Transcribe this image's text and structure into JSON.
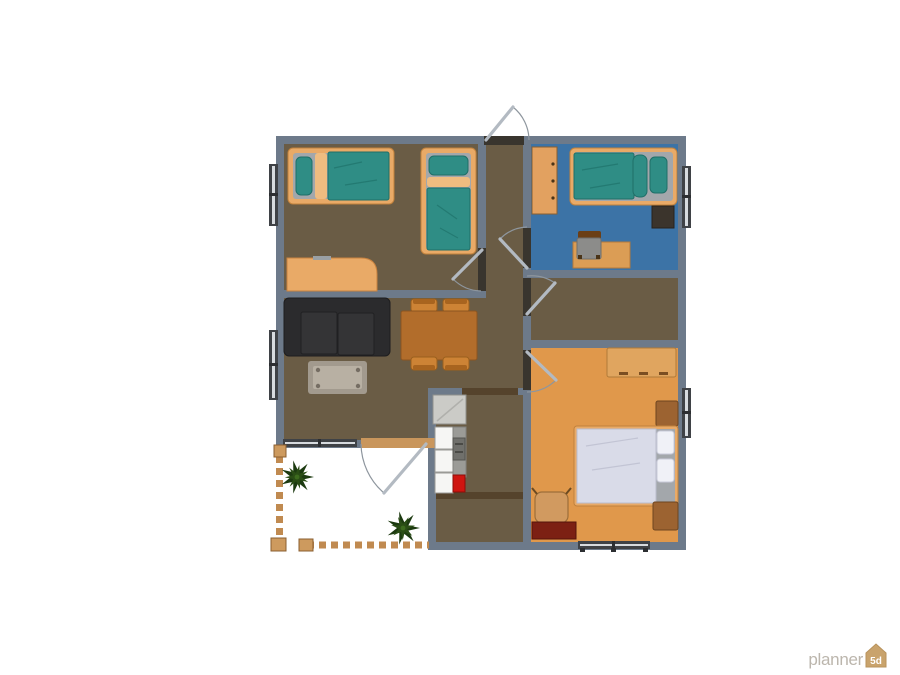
{
  "watermark": {
    "brand": "planner",
    "badge": "5d"
  },
  "palette": {
    "wall": "#6d7a8a",
    "floor_wood_brown": "#6a5c45",
    "floor_blue": "#3c73a6",
    "floor_orange": "#e0984b",
    "patio_floor": "#ffffff",
    "furniture_tan": "#e9aa67",
    "mattress_teal": "#2f8d85",
    "sofa_black": "#2b2b2d",
    "dining_table_wood": "#b26d2b",
    "duvet_white": "#d9dbe8",
    "kitchen_red_appliance": "#cf1510",
    "vanity_maroon": "#7c2013",
    "plant_green": "#1c3a10",
    "fence_tan": "#c08a50",
    "door_frame_dark": "#39352e",
    "logo_gray": "#bcb6ad",
    "logo_badge_tan": "#c9a36c"
  },
  "floor_plan": {
    "rooms": [
      {
        "name": "bedroom-top-left",
        "floor": "wood-brown",
        "furniture": [
          "single-bed-horizontal",
          "single-bed-vertical",
          "desk"
        ]
      },
      {
        "name": "bedroom-top-right",
        "floor": "blue",
        "furniture": [
          "wardrobe",
          "single-bed",
          "tv-stand",
          "desk",
          "desk-chair"
        ]
      },
      {
        "name": "corridor",
        "floor": "wood-brown",
        "furniture": []
      },
      {
        "name": "middle-room",
        "floor": "wood-brown",
        "furniture": []
      },
      {
        "name": "bedroom-bottom-right",
        "floor": "orange",
        "furniture": [
          "dresser",
          "double-bed",
          "nightstand-top",
          "nightstand-bottom",
          "armchair",
          "vanity-table"
        ]
      },
      {
        "name": "living-dining-room",
        "floor": "wood-brown",
        "furniture": [
          "sofa",
          "coffee-table",
          "dining-table",
          "dining-chair-1",
          "dining-chair-2",
          "dining-chair-3",
          "dining-chair-4"
        ]
      },
      {
        "name": "kitchen",
        "floor": "wood-brown",
        "furniture": [
          "fridge",
          "counter-cabinets",
          "stove-unit",
          "red-appliance"
        ]
      },
      {
        "name": "patio",
        "floor": "white",
        "furniture": [
          "plant-1",
          "plant-2",
          "fence-left",
          "fence-bottom"
        ]
      }
    ],
    "doors": [
      "entrance-top",
      "bedroom-top-left-door",
      "bedroom-top-right-door",
      "middle-room-door",
      "bedroom-bottom-right-door",
      "patio-door"
    ],
    "openings": [
      "kitchen-dining-portal",
      "kitchen-hall-portal"
    ],
    "windows": [
      "left-upper",
      "left-lower",
      "right-blue-room",
      "right-orange-room",
      "bottom-living-room",
      "bottom-orange-room"
    ]
  }
}
